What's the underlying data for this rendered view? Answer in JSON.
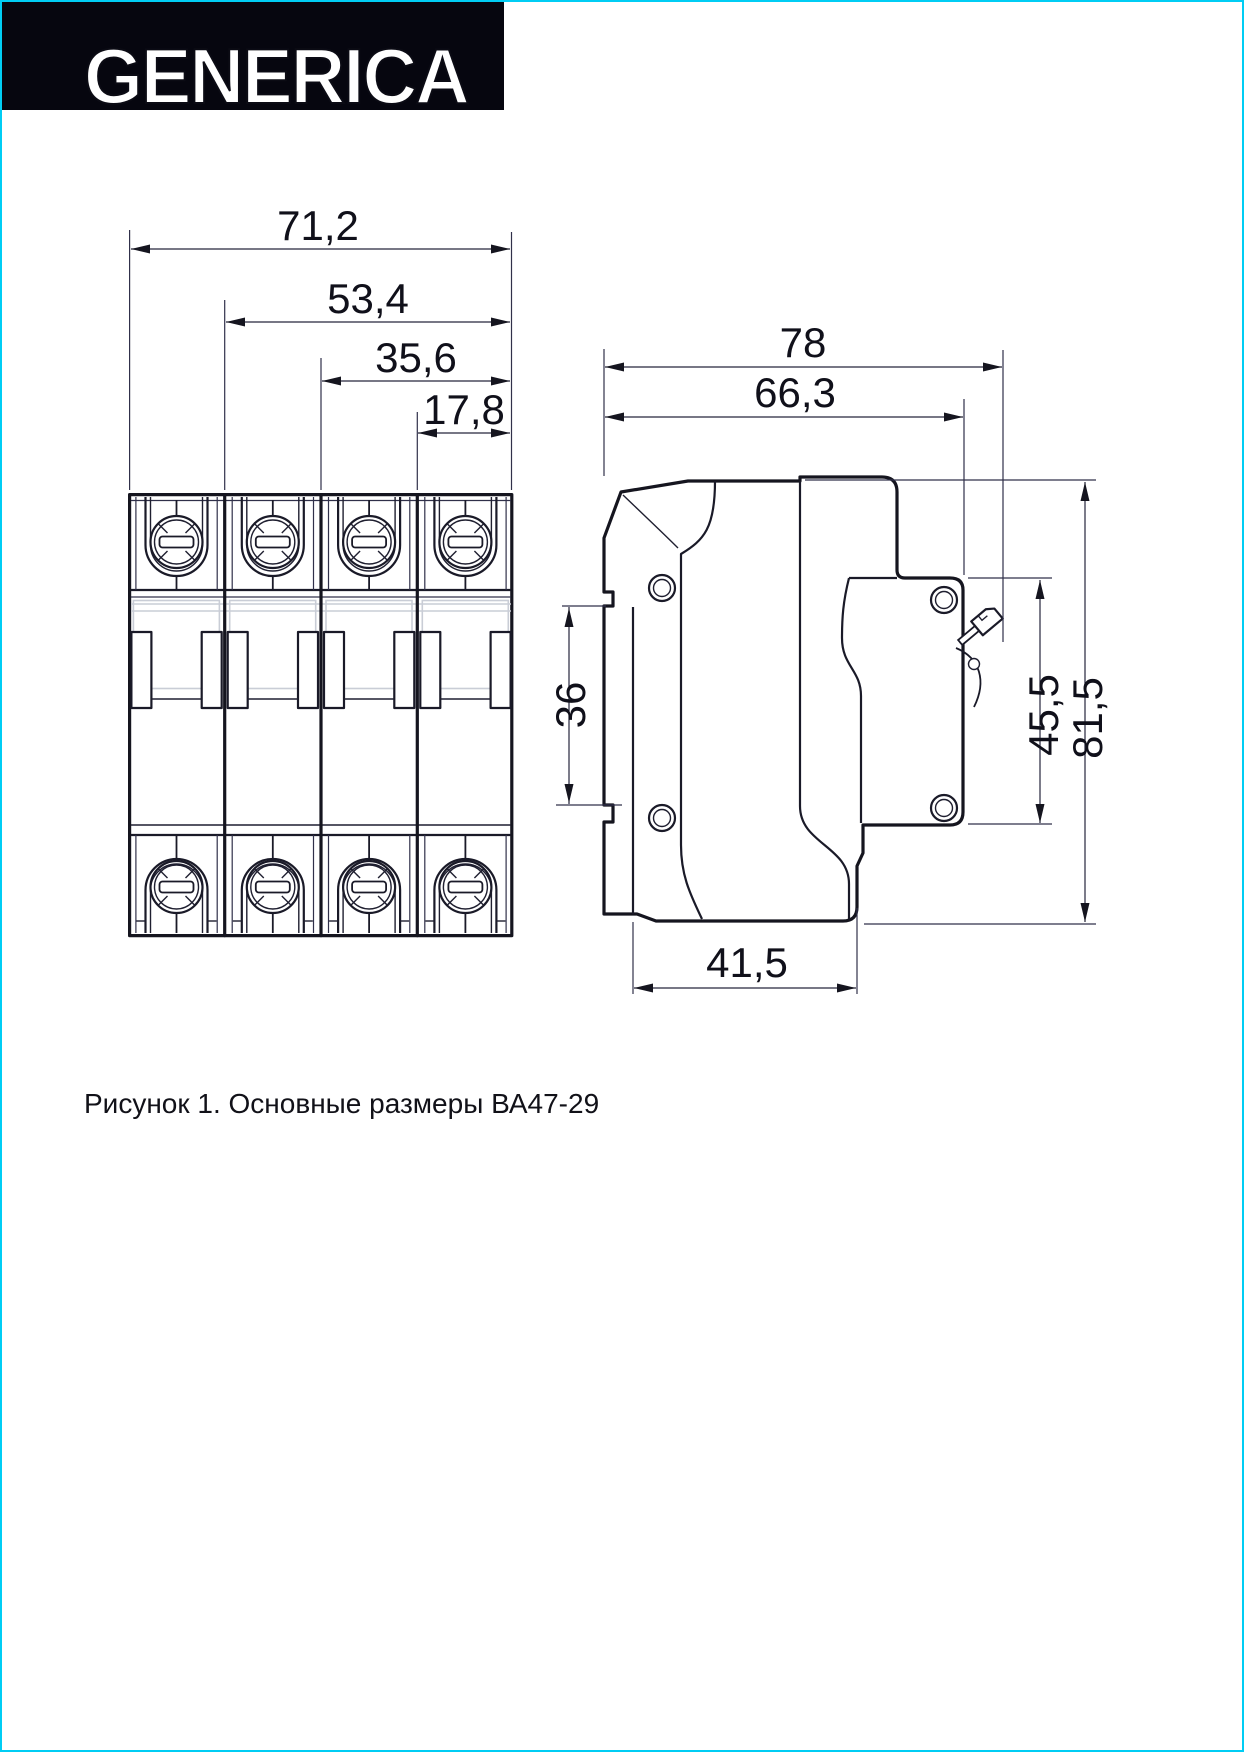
{
  "header": {
    "logo_text": "GENERICA"
  },
  "colors": {
    "accent_border": "#00cdf4",
    "logo_bar": "#06060f",
    "drawing_lines": "#15151f",
    "detail_gray": "#c9cdd6"
  },
  "figure": {
    "caption": "Рисунок 1. Основные размеры ВА47-29",
    "product": "ВА47-29",
    "front_view": {
      "description": "front view, 4-pole circuit breaker",
      "dimensions": {
        "width_4_modules": "71,2",
        "width_3_modules": "53,4",
        "width_2_modules": "35,6",
        "module_width": "17,8"
      }
    },
    "side_view": {
      "description": "side view with DIN-rail mount",
      "dimensions": {
        "depth_total": "78",
        "depth_body": "66,3",
        "din_slot_height": "36",
        "terminal_height": "45,5",
        "height_total": "81,5",
        "base_depth": "41,5"
      }
    }
  }
}
